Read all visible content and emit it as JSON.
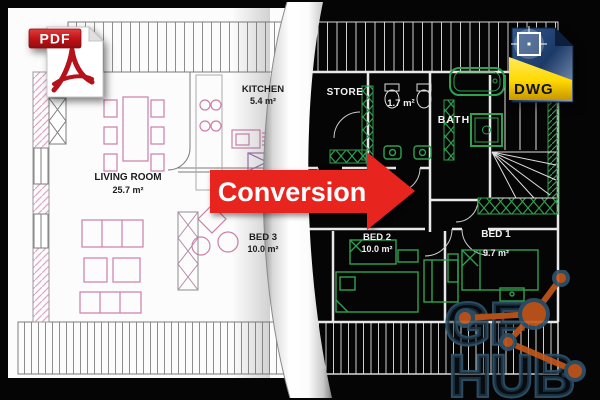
{
  "arrow": {
    "label": "Conversion"
  },
  "file_badges": {
    "pdf": {
      "label": "PDF"
    },
    "dwg": {
      "label": "DWG"
    }
  },
  "floor_plan_pdf": {
    "living_room": {
      "name": "LIVING ROOM",
      "area": "25.7 m²"
    },
    "kitchen": {
      "name": "KITCHEN",
      "area": "5.4 m²"
    },
    "bed3": {
      "name": "BED 3",
      "area": "10.0 m²"
    }
  },
  "floor_plan_dwg": {
    "store": {
      "name": "STORE"
    },
    "wc": {
      "area": "1.7 m²"
    },
    "bath": {
      "name": "BATH"
    },
    "bed2": {
      "name": "BED 2",
      "area": "10.0 m²"
    },
    "bed1": {
      "name": "BED 1",
      "area": "9.7 m²"
    }
  },
  "watermark": {
    "line1": "GF",
    "line2": "HUB"
  },
  "colors": {
    "arrow_red": "#e8241e",
    "pdf_banner_red": "#b5121b",
    "dwg_page_blue": "#2a4a7e",
    "dwg_banner_yellow": "#ffd900",
    "cad_green": "#2fa050",
    "furniture_pink": "#cc7fa8",
    "watermark_orange": "#c2571c",
    "watermark_blue": "#2e5269"
  }
}
